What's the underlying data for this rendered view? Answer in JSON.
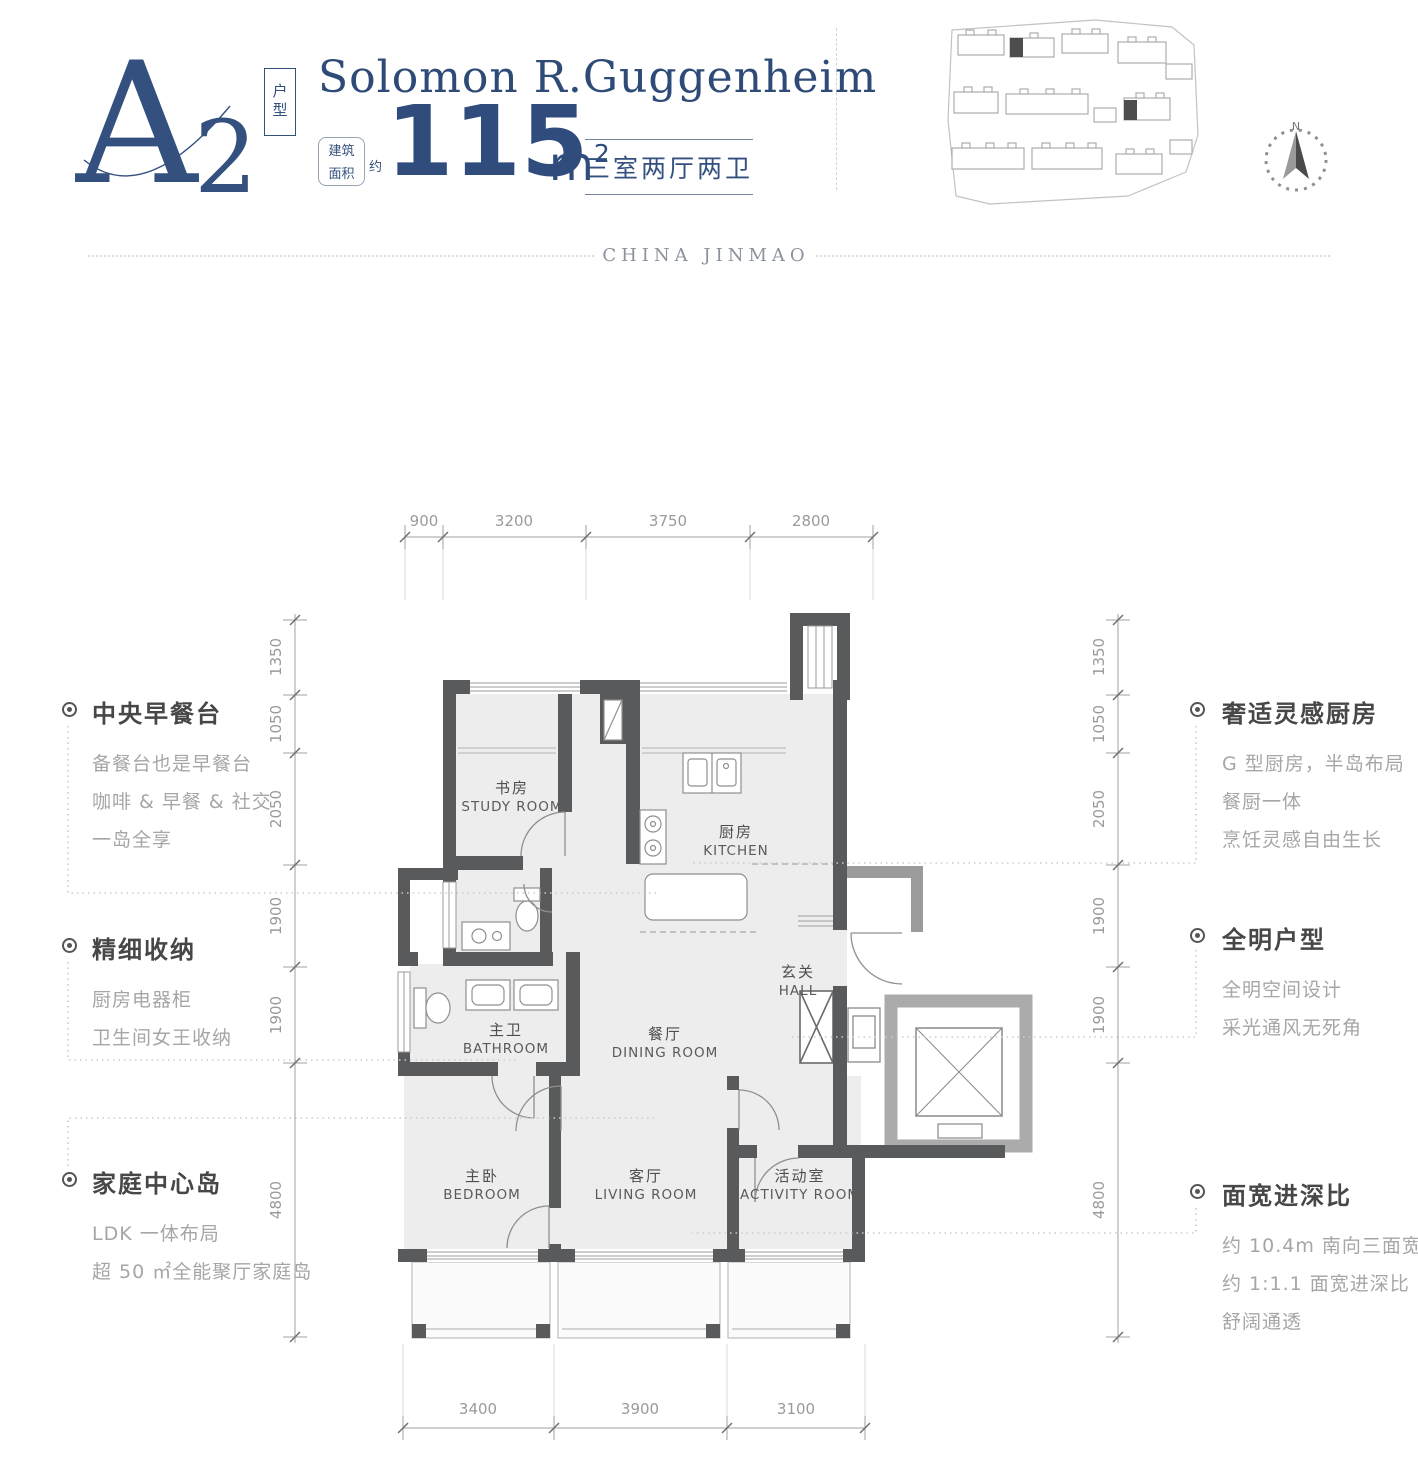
{
  "header": {
    "unit_code_a": "A",
    "unit_code_num": "2",
    "unit_tag": "户型",
    "project_title": "Solomon R.Guggenheim",
    "area_label_1": "建筑",
    "area_label_2": "面积",
    "area_approx": "约",
    "area_value": "115",
    "area_unit_base": "m",
    "area_unit_exp": "2",
    "layout_summary": "三室两厅两卫",
    "brand": "CHINA JINMAO",
    "compass_north": "N"
  },
  "floorplan": {
    "rooms": [
      {
        "cn": "书房",
        "en": "STUDY ROOM"
      },
      {
        "cn": "厨房",
        "en": "KITCHEN"
      },
      {
        "cn": "玄关",
        "en": "HALL"
      },
      {
        "cn": "餐厅",
        "en": "DINING ROOM"
      },
      {
        "cn": "主卫",
        "en": "BATHROOM"
      },
      {
        "cn": "主卧",
        "en": "BEDROOM"
      },
      {
        "cn": "客厅",
        "en": "LIVING ROOM"
      },
      {
        "cn": "活动室",
        "en": "ACTIVITY ROOM"
      }
    ],
    "dimensions": {
      "top": [
        "900",
        "3200",
        "3750",
        "2800"
      ],
      "bottom": [
        "3400",
        "3900",
        "3100"
      ],
      "left": [
        "1350",
        "1050",
        "2050",
        "1900",
        "1900",
        "4800"
      ],
      "right": [
        "1350",
        "1050",
        "2050",
        "1900",
        "1900",
        "4800"
      ]
    }
  },
  "annotations": {
    "left": [
      {
        "title": "中央早餐台",
        "lines": [
          "备餐台也是早餐台",
          "咖啡 & 早餐 & 社交",
          "一岛全享"
        ]
      },
      {
        "title": "精细收纳",
        "lines": [
          "厨房电器柜",
          "卫生间女王收纳"
        ]
      },
      {
        "title": "家庭中心岛",
        "lines": [
          "LDK 一体布局",
          "超 50 ㎡全能聚厅家庭岛"
        ]
      }
    ],
    "right": [
      {
        "title": "奢适灵感厨房",
        "lines": [
          "G 型厨房，半岛布局",
          "餐厨一体",
          "烹饪灵感自由生长"
        ]
      },
      {
        "title": "全明户型",
        "lines": [
          "全明空间设计",
          "采光通风无死角"
        ]
      },
      {
        "title": "面宽进深比",
        "lines": [
          "约 10.4m 南向三面宽",
          "约 1:1.1 面宽进深比",
          "舒阔通透"
        ]
      }
    ]
  }
}
